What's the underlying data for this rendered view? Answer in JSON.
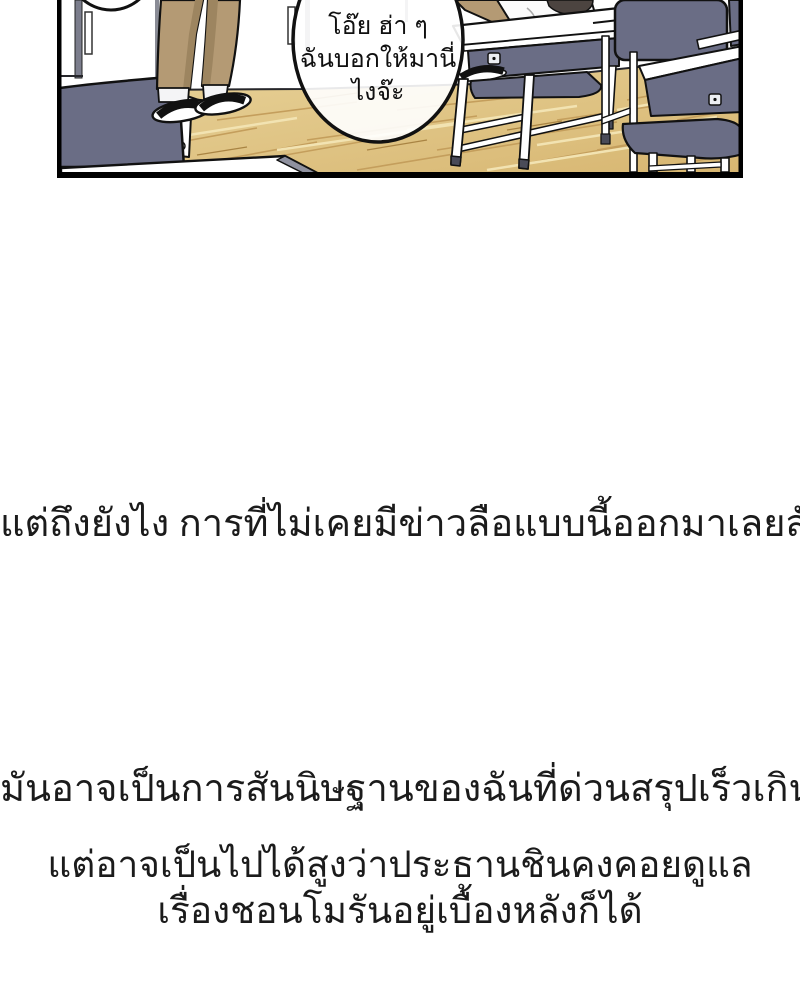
{
  "page": {
    "type": "webtoon-comic-page",
    "background_color": "#ffffff"
  },
  "panel": {
    "border_color": "#000000",
    "speech_bubble": {
      "line1": "โอ๊ย ฮ่า ๆ",
      "line2": "ฉันบอกให้มานี่",
      "line3": "ไงจ๊ะ"
    },
    "palette": {
      "furniture_navy": "#6a6d85",
      "wood_floor_light": "#e9d49b",
      "wood_floor_dark": "#d7b671",
      "wood_streak": "#c49e5c",
      "pants_khaki": "#b49a74",
      "pants_shadow": "#9d8560",
      "hair": "#4c4440",
      "outline": "#111111"
    }
  },
  "narration": {
    "block1": "แต่ถึงยังไง การที่ไม่เคยมีข่าวลือแบบนี้ออกมาเลยสักครั้ง...",
    "block2": "มันอาจเป็นการสันนิษฐานของฉันที่ด่วนสรุปเร็วเกินไปหน่อย",
    "block3_line1": "แต่อาจเป็นไปได้สูงว่าประธานชินคงคอยดูแล",
    "block3_line2": "เรื่องชอนโมรันอยู่เบื้องหลังก็ได้"
  }
}
